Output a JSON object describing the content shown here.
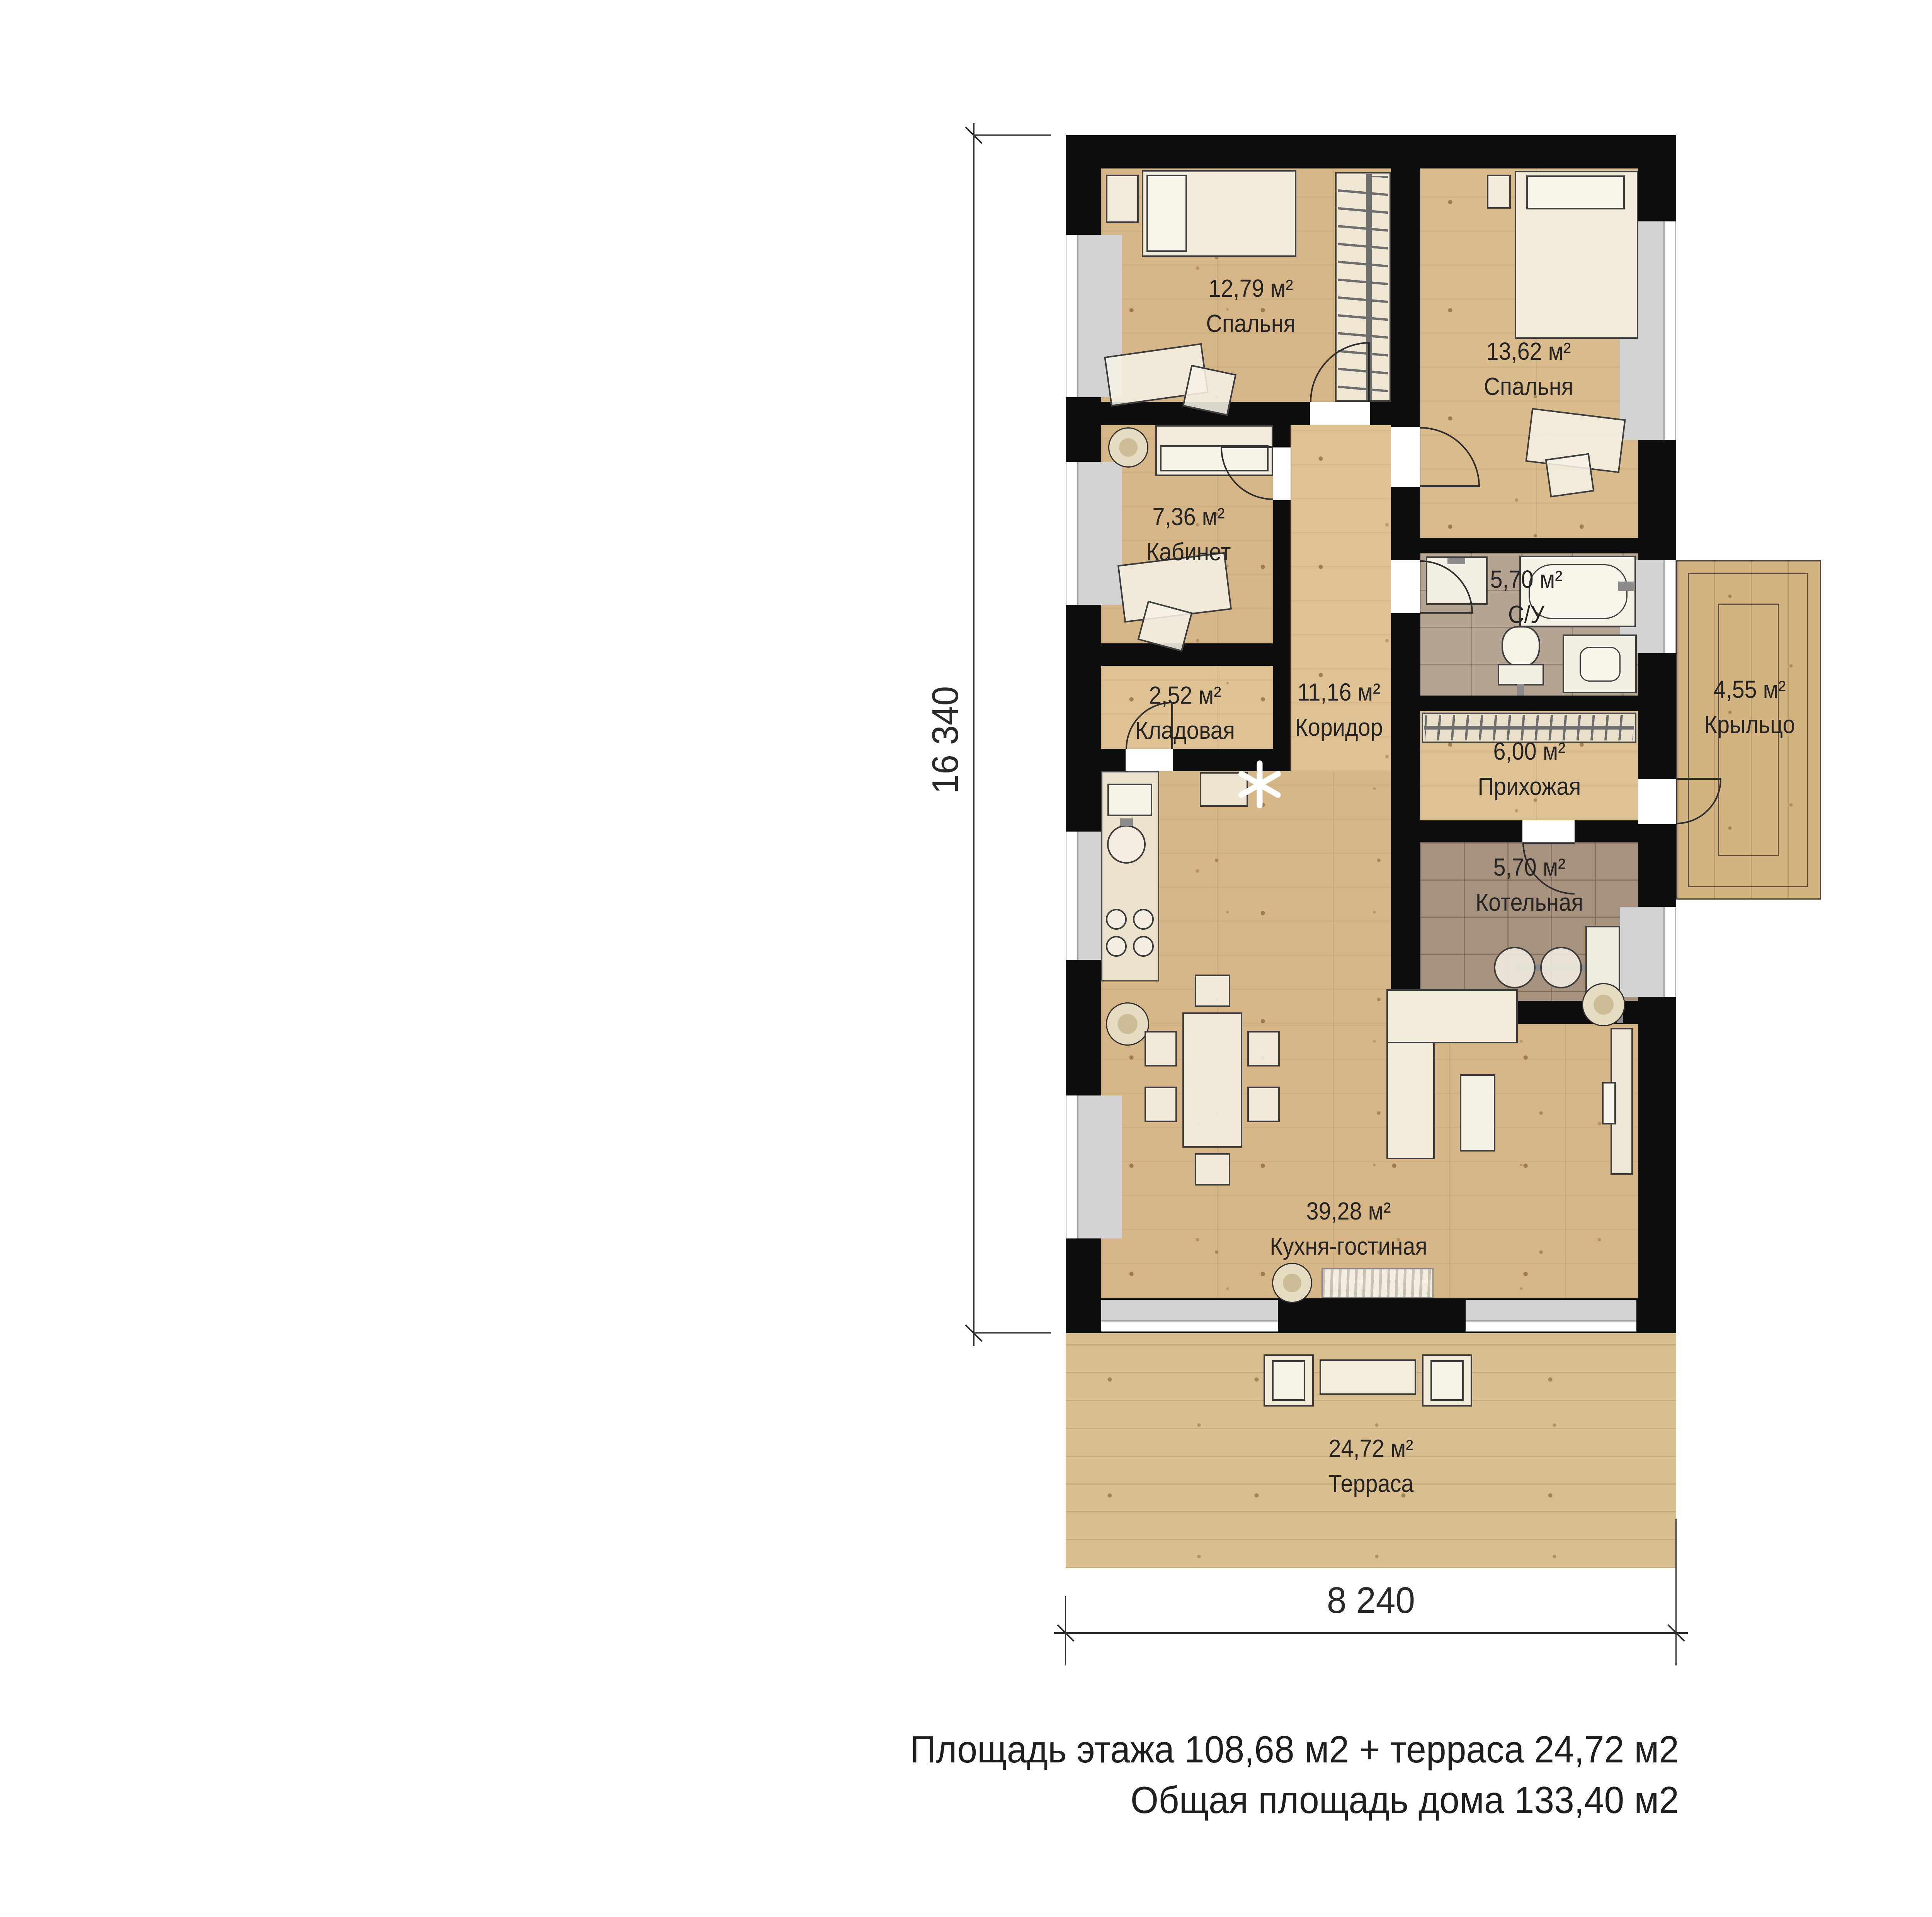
{
  "rooms": [
    {
      "id": "bedroom-1",
      "area": "12,79 м²",
      "name": "Спальня"
    },
    {
      "id": "bedroom-2",
      "area": "13,62 м²",
      "name": "Спальня"
    },
    {
      "id": "office",
      "area": "7,36 м²",
      "name": "Кабинет"
    },
    {
      "id": "bathroom",
      "area": "5,70 м²",
      "name": "С/У"
    },
    {
      "id": "storage",
      "area": "2,52 м²",
      "name": "Кладовая"
    },
    {
      "id": "corridor",
      "area": "11,16 м²",
      "name": "Коридор"
    },
    {
      "id": "hallway",
      "area": "6,00 м²",
      "name": "Прихожая"
    },
    {
      "id": "boiler-room",
      "area": "5,70 м²",
      "name": "Котельная"
    },
    {
      "id": "porch",
      "area": "4,55 м²",
      "name": "Крыльцо"
    },
    {
      "id": "kitchen-living",
      "area": "39,28 м²",
      "name": "Кухня-гостиная"
    },
    {
      "id": "terrace",
      "area": "24,72 м²",
      "name": "Терраса"
    }
  ],
  "dimensions": {
    "vertical": "16 340",
    "horizontal": "8 240"
  },
  "summary": {
    "line1": "Площадь этажа 108,68 м2 + терраса 24,72 м2",
    "line2": "Общая площадь дома 133,40 м2"
  },
  "colors": {
    "wall": "#0d0d0d",
    "wood_floor": "#d6b687",
    "terrace_wood": "#d9be90",
    "bath_tile": "#b6a493",
    "boiler_tile": "#a7927e",
    "window_glass": "#d2d2d2",
    "text": "#242424"
  }
}
